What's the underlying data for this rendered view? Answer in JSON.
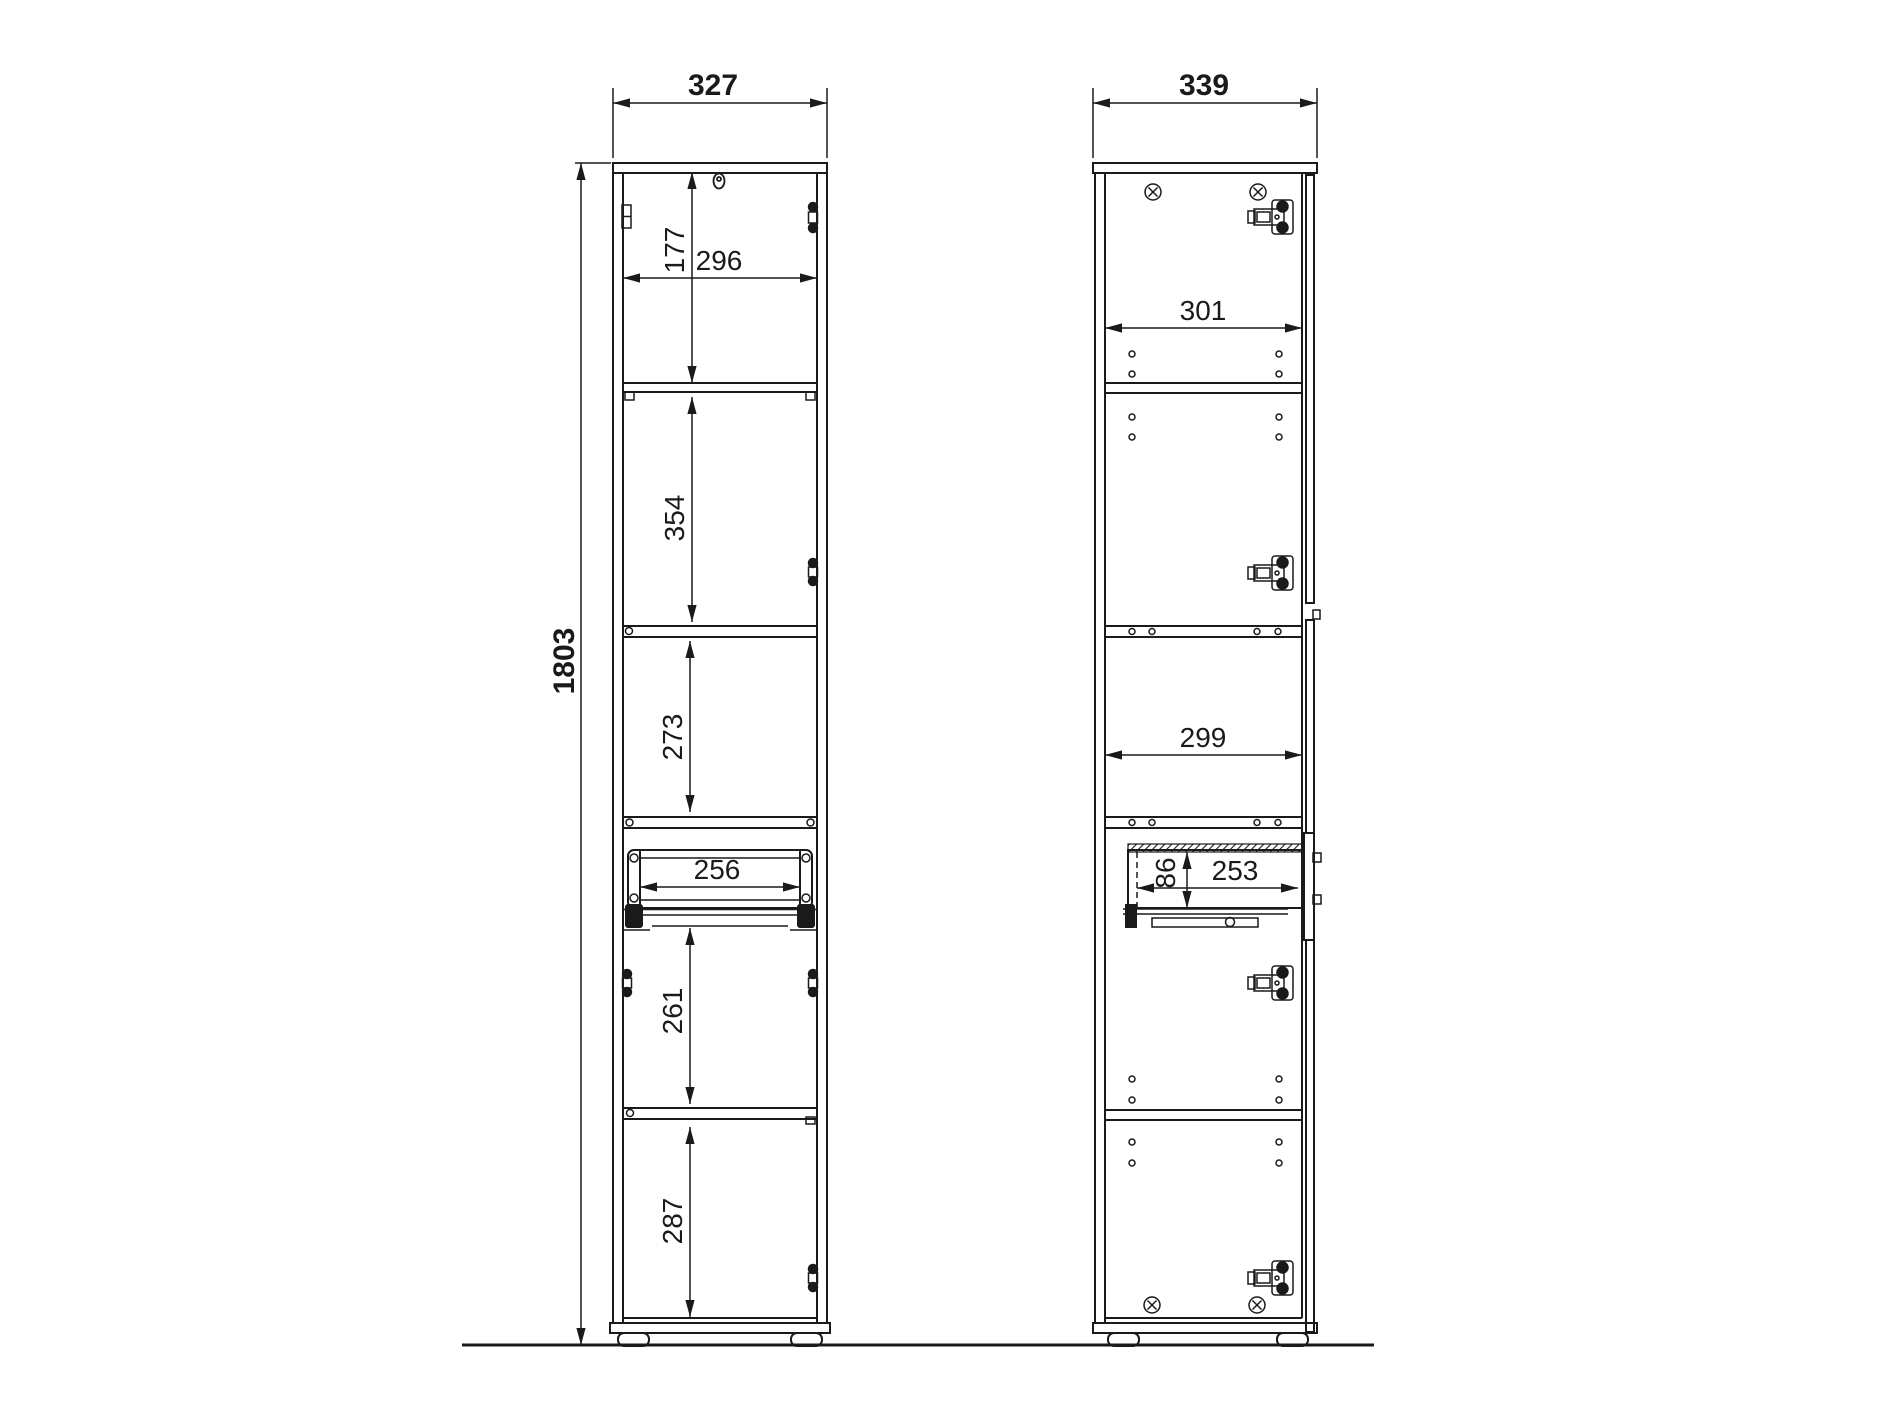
{
  "drawing": {
    "background_color": "#ffffff",
    "line_color": "#1a1a1a",
    "front_view": {
      "overall_width": "327",
      "overall_height": "1803",
      "top_compartment_height": "177",
      "interior_width": "296",
      "second_compartment_height": "354",
      "third_compartment_height": "273",
      "drawer_interior_width": "256",
      "fourth_compartment_height": "261",
      "bottom_compartment_height": "287"
    },
    "side_view": {
      "overall_depth": "339",
      "interior_depth_upper": "301",
      "interior_depth_middle": "299",
      "drawer_height": "86",
      "drawer_depth": "253"
    }
  }
}
